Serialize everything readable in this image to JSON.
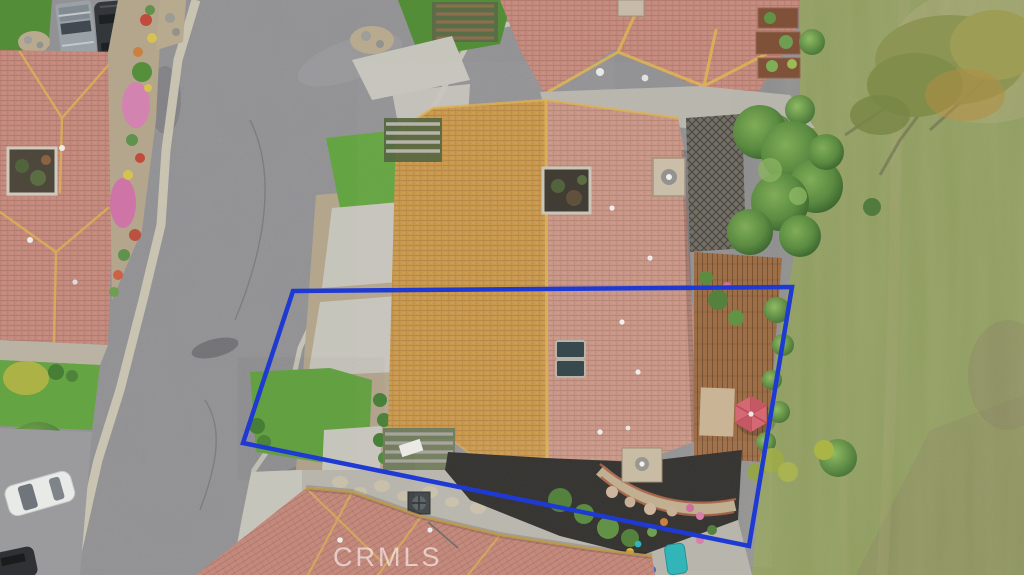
{
  "meta": {
    "type": "aerial-drone-photograph",
    "subject": "overhead view of single-story tile-roof home with property lot outlined",
    "canvas": {
      "width": 1024,
      "height": 575
    }
  },
  "watermark": {
    "text": "CRMLS"
  },
  "boundary": {
    "points": "293,291 792,287 749,546 243,443",
    "stroke_width": "4.5"
  },
  "features": {
    "street": "asphalt street",
    "main_roof": "main house tile roof",
    "neighbor_roofs": "neighboring tile roofs",
    "field": "grass field",
    "deck": "wood backyard deck",
    "umbrella": "pink patio umbrella",
    "vehicles": "parked vehicles",
    "skylights": "roof skylights",
    "chimney": "roof chimney",
    "courtyard": "roof courtyard opening",
    "pool": "small teal kiddie pool"
  },
  "palette": {
    "road": "#8e8e90",
    "roadLight": "#a2a2a4",
    "concrete": "#c6c4bb",
    "sidewalk": "#cfc8b4",
    "roofSalmon": "#c28578",
    "roofOrange": "#c79344",
    "roofPink": "#c79181",
    "ridgeGold": "#ddb04e",
    "lawn": "#5fa23c",
    "lawnDark": "#4c8a30",
    "field": "#91a05e",
    "fieldDry": "#b3ab7c",
    "treeDark": "#3c6b2d",
    "treeMid": "#55883a",
    "treeLight": "#7cab51",
    "deck": "#9a6a42",
    "mulch": "#2b2926",
    "umbrella": "#d4626e",
    "boundary": "#1e3ad2",
    "watermark": "rgba(255,255,255,0.58)",
    "pathTan": "#c7b493",
    "brick": "#a95f43",
    "poolTeal": "#2ab4b8",
    "carWhite": "#e9ebe8",
    "vehicleDark": "#2b2f33",
    "truckGray": "#97a0a6",
    "soil": "#b3a48a",
    "patio": "#b7b4aa"
  }
}
